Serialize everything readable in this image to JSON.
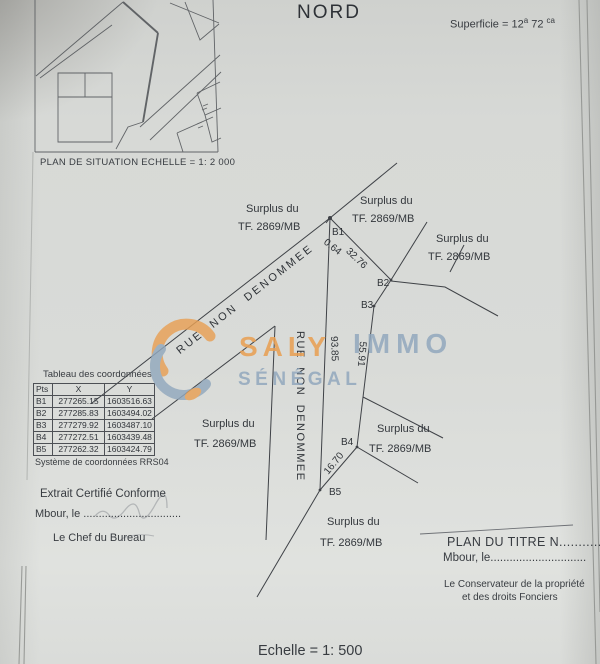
{
  "header": {
    "north": "NORD",
    "superficie_prefix": "Superficie = ",
    "superficie_v1": "12",
    "superficie_u1": "a",
    "superficie_v2": "72",
    "superficie_u2": "ca"
  },
  "situation": {
    "caption": "PLAN DE SITUATION ECHELLE = 1: 2 000"
  },
  "watermark": {
    "word1": "SALY",
    "word2": "IMMO",
    "word3": "SÉNÉGAL",
    "orange": "#e8a055",
    "blue": "#92a8bd",
    "logo_icon": "saly-immo-logo-swirl"
  },
  "plan": {
    "surplus": {
      "line1": "Surplus du",
      "line2": "TF. 2869/MB"
    },
    "street_label_diagonal": "RUE  NON  DENOMMEE",
    "street_label_vertical": "RUE  NON  DENOMMEE",
    "points": [
      "B1",
      "B2",
      "B3",
      "B4",
      "B5"
    ],
    "distances": {
      "b1_offset": "0.64",
      "b1_b2": "32.76",
      "b1_b5": "93.85",
      "b3_b4": "55.91",
      "b4_b5": "16.70"
    }
  },
  "table": {
    "title": "Tableau des coordonnées",
    "headers": [
      "Pts",
      "X",
      "Y"
    ],
    "rows": [
      [
        "B1",
        "277265.15",
        "1603516.63"
      ],
      [
        "B2",
        "277285.83",
        "1603494.02"
      ],
      [
        "B3",
        "277279.92",
        "1603487.10"
      ],
      [
        "B4",
        "277272.51",
        "1603439.48"
      ],
      [
        "B5",
        "277262.32",
        "1603424.79"
      ]
    ],
    "footer": "Système de coordonnées RRS04"
  },
  "certification": {
    "line1": "Extrait Certifié Conforme",
    "line2": "Mbour, le ................................",
    "line3": "Le Chef du Bureau"
  },
  "title_block": {
    "line1": "PLAN DU TITRE N............",
    "line2": "Mbour, le..............................",
    "line3": "Le Conservateur de la propriété",
    "line4": "et des droits Fonciers"
  },
  "footer": {
    "scale": "Echelle = 1: 500"
  }
}
